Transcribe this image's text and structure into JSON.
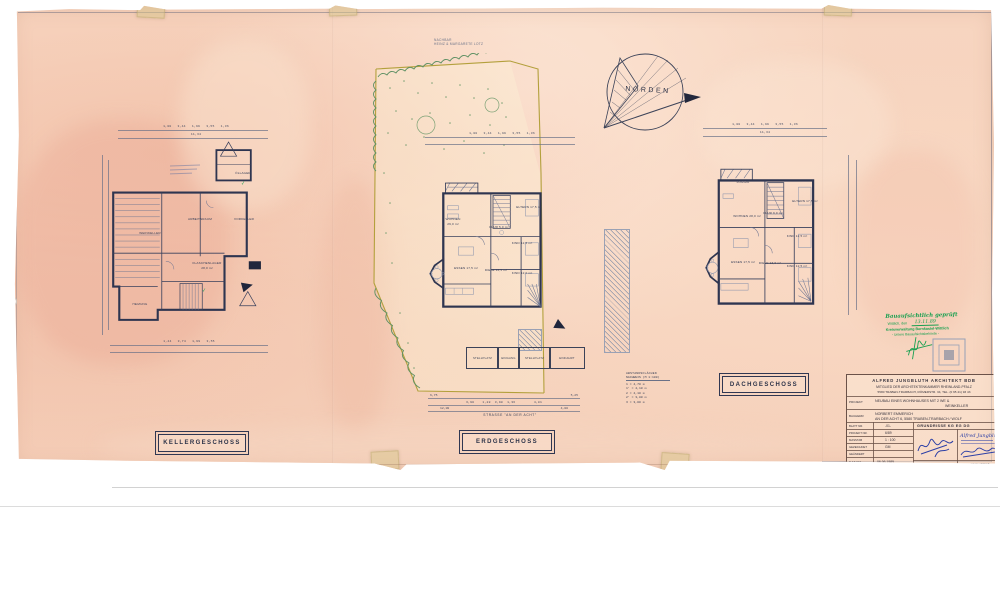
{
  "neighbor": {
    "line1": "NACHBAR",
    "line2": "HEINZ & MARGARETE LOTZ"
  },
  "north": {
    "label": "NORDEN"
  },
  "kg": {
    "title": "KELLERGESCHOSS",
    "dims1": "1,00   3,44   1,99   3,55   1,36",
    "dims2": "11,34",
    "dims3": "1,44   3,74   1,99   3,55",
    "rooms": {
      "weinkeller": "WEINKELLER",
      "arbeitsraum": "ARBEITSRAUM",
      "vorkeller": "VORKELLER",
      "flaschenlager": "FLASCHENLAGER",
      "flaschenlager_area": "28,0 m²",
      "oellager": "ÖLLAGER",
      "heizung": "HEIZUNG"
    }
  },
  "eg": {
    "title": "ERDGESCHOSS",
    "street": "STRASSE   \"AN DER ACHT\"",
    "dims_top": "1,00   3,44   1,99   3,55   1,36",
    "dims1a": "6,75",
    "dims1b": "5,25",
    "dims2": "3,90    1,28  3,98  1,36         4,81",
    "dims3a": "12,00",
    "dims3b": "4,00",
    "stalls": {
      "s1": "STELLPLATZ",
      "s2": "EINGANG",
      "s3": "STELLPLATZ",
      "s4": "EINFAHRT"
    },
    "rooms": {
      "wohnen": "WOHNEN",
      "wohnen_area": "29,0 m²",
      "eltern": "ELTERN 17,5 m²",
      "flur": "FLUR 5,0 m²",
      "kind1": "KIND 12,5 m²",
      "essen": "ESSEN 17,5 m²",
      "diele": "DIELE 13,5 m²",
      "kind2": "KIND 12,0 m²"
    }
  },
  "dg": {
    "title": "DACHGESCHOSS",
    "dims1": "1,00   3,44   1,99   3,55   1,36",
    "dims2": "11,34",
    "rooms": {
      "loggia": "LOGGIA",
      "wohnen": "WOHNEN 28,0 m²",
      "eltern": "ELTERN 17,5 m²",
      "flur": "FLUR 9,0 m²",
      "kind1": "KIND 12,5 m²",
      "kind2": "KIND 12,5 m²",
      "essen": "ESSEN 17,5 m²",
      "diele": "DIELE 13,0 m²"
    }
  },
  "legend": {
    "title1": "ABSTANDSFLÄCHEN",
    "title2": "NACHWEIS (M 1:100)",
    "rows_text": "1  =  4,70 m\n1' =  4,10 m\n2  =  4,10 m\n2' =  3,80 m\n3  =  3,00 m"
  },
  "stamp": {
    "line1": "Bauaufsichtlich geprüft",
    "line2_label": "Wittlich, den",
    "line2_date": "13.11.89",
    "line3": "Kreisverwaltung Bernkastel-Wittlich",
    "line4": "- Untere Bauaufsichtsbehörde -"
  },
  "titleblock": {
    "header1": "ALFRED JUNGBLUTH ARCHITEKT BDB",
    "header2": "MITGLIED DER ARCHITEKTENKAMMER RHEINLAND-PFALZ",
    "header3": "5580 TRABEN-TRARBACH, RÖMERSTR. 34, TEL. (0 65 41) 93 43",
    "projekt_label": "PROJEKT",
    "projekt_value1": "NEUBAU EINES WOHNHAUSES  MIT 2 WE &",
    "projekt_value2": "WEINKELLER",
    "bauherr_label": "BAUHERR",
    "bauherr_value1": "NORBERT  EMMERICH",
    "bauherr_value2": "AN DER ACHT 6,  5580 TRABEN-TRARBACH / WOLF",
    "blatt_label": "BLATT NR.",
    "blatt_value": "-01-",
    "projnr_label": "PROJEKT NR.",
    "projnr_value": "6/89",
    "masstab_label": "MASSTAB",
    "masstab_value": "1 : 100",
    "gezeichnet_label": "GEZEICHNET",
    "gezeichnet_value": "GM",
    "geaendert_label": "GEÄNDERT",
    "geaendert_value": "",
    "datum_label": "DATUM",
    "datum_value": "06.06.1989",
    "content_value": "GRUNDRISSE   KG  EG  DG",
    "sig_bauherr_label": "BAUHERR",
    "sig_architekt_label": "ARCHITEKT",
    "architekt_stamp_name": "Alfred Jungbluth"
  }
}
